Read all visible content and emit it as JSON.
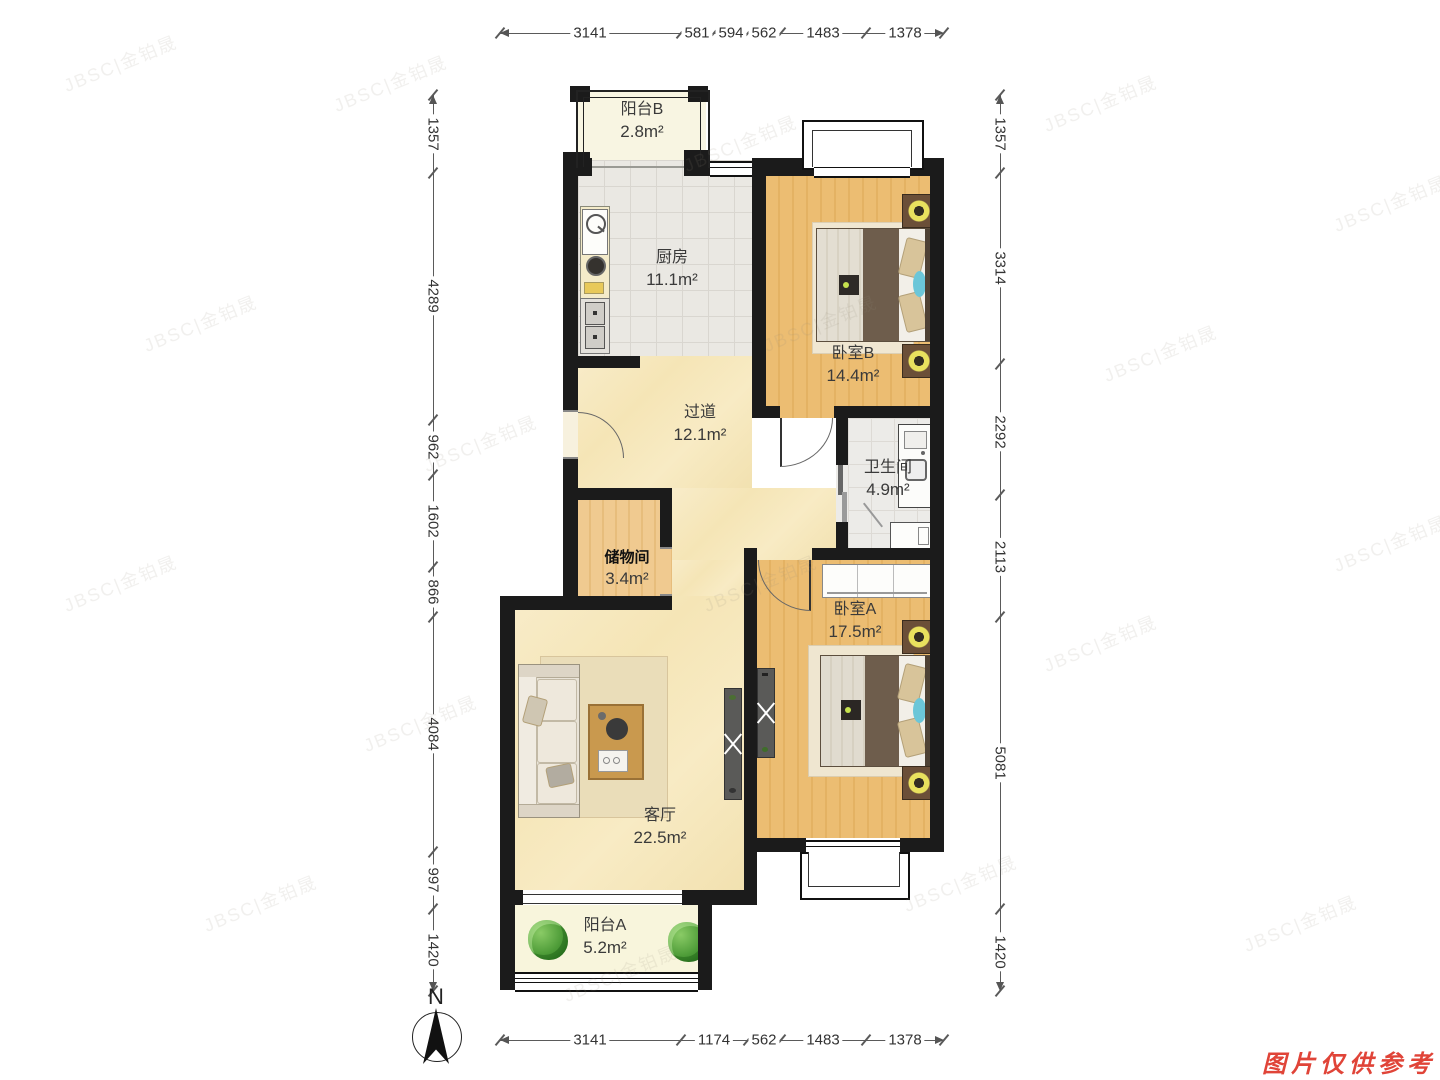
{
  "rooms": [
    {
      "name": "阳台B",
      "area": "2.8m²"
    },
    {
      "name": "厨房",
      "area": "11.1m²"
    },
    {
      "name": "卧室B",
      "area": "14.4m²"
    },
    {
      "name": "过道",
      "area": "12.1m²"
    },
    {
      "name": "卫生间",
      "area": "4.9m²"
    },
    {
      "name": "储物间",
      "area": "3.4m²"
    },
    {
      "name": "卧室A",
      "area": "17.5m²"
    },
    {
      "name": "客厅",
      "area": "22.5m²"
    },
    {
      "name": "阳台A",
      "area": "5.2m²"
    }
  ],
  "dims": {
    "top": [
      "3141",
      "581",
      "594",
      "562",
      "1483",
      "1378"
    ],
    "bottom": [
      "3141",
      "1174",
      "562",
      "1483",
      "1378"
    ],
    "left": [
      "1357",
      "4289",
      "962",
      "1602",
      "866",
      "4084",
      "997",
      "1420"
    ],
    "right": [
      "1357",
      "3314",
      "2292",
      "2113",
      "5081",
      "1420"
    ]
  },
  "compass": {
    "north_label": "N"
  },
  "watermark": {
    "text": "JBSC|金铂晟"
  },
  "disclaimer": {
    "text": "图片仅供参考"
  },
  "colors": {
    "wall": "#1b1b1b",
    "wood_floor": "#ecbd72",
    "cream_floor": "#f6e7bd",
    "tile_floor": "#eae8e3",
    "balcony_floor": "#f8f5e2",
    "disclaimer_red": "#e04438"
  }
}
